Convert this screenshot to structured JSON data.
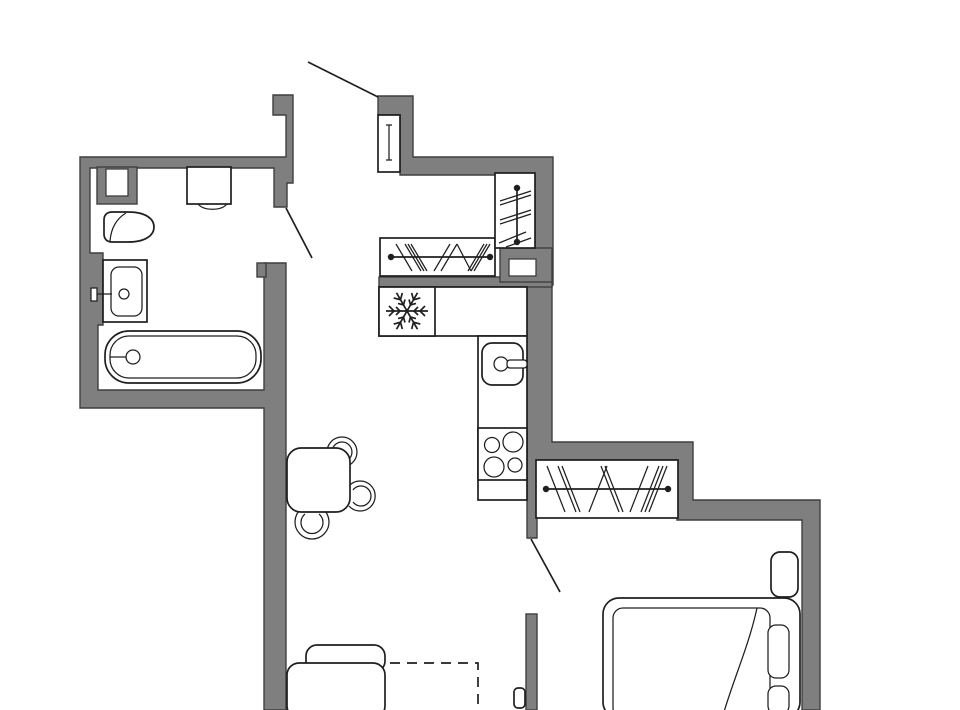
{
  "title": "One-room apartment floor plan",
  "colors": {
    "wall": "#7f7f7f",
    "wall_outline": "#3f3f3f",
    "line": "#1f1f1f",
    "background": "#fcfcfd",
    "paper": "#ffffff"
  },
  "rooms": [
    {
      "name": "bathroom",
      "furniture": [
        "washing-machine",
        "toilet",
        "wash-basin",
        "bathtub",
        "duct-shaft"
      ]
    },
    {
      "name": "hallway",
      "furniture": [
        "entrance-door",
        "wardrobe-hall",
        "wardrobe-side",
        "duct-shaft"
      ]
    },
    {
      "name": "kitchen",
      "furniture": [
        "refrigerator",
        "counter",
        "kitchen-sink",
        "stove"
      ]
    },
    {
      "name": "bedroom",
      "furniture": [
        "wardrobe-bedroom",
        "bed",
        "mattress",
        "pillows",
        "nightstand",
        "blanket"
      ]
    },
    {
      "name": "living-room",
      "furniture": [
        "dining-table",
        "chairs",
        "sofa",
        "tv",
        "planned-zone-dashed"
      ]
    }
  ],
  "doors": {
    "entrance": 1,
    "bathroom": 1,
    "bedroom": 1
  },
  "icons": [
    {
      "name": "snowflake-icon",
      "meaning": "refrigerator position"
    }
  ],
  "wardrobe_symbol": "rail-with-hangers",
  "chairs_count": 3,
  "stove_burners": 4
}
